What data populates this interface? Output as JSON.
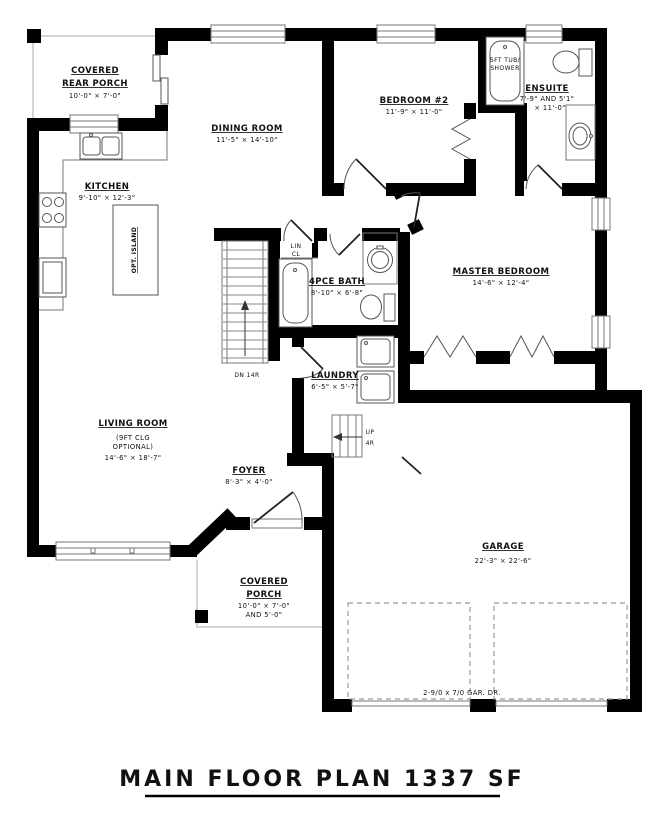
{
  "page": {
    "title": "MAIN FLOOR PLAN 1337 SF"
  },
  "colors": {
    "walls": "#000000",
    "thin_lines": "#777777",
    "text": "#111111",
    "background": "#ffffff"
  },
  "rooms": {
    "rear_porch": {
      "line1": "COVERED",
      "line2": "REAR PORCH",
      "dims": "10'-0\" × 7'-0\""
    },
    "dining": {
      "name": "DINING ROOM",
      "dims": "11'-5\" × 14'-10\""
    },
    "bedroom2": {
      "name": "BEDROOM #2",
      "dims": "11'-9\" × 11'-0\""
    },
    "ensuite": {
      "name": "ENSUITE",
      "dims1": "7'-9\" AND 5'1\"",
      "dims2": "× 11'-0\""
    },
    "kitchen": {
      "name": "KITCHEN",
      "dims": "9'-10\" × 12'-3\""
    },
    "master": {
      "name": "MASTER BEDROOM",
      "dims": "14'-6\" × 12'-4\""
    },
    "bath": {
      "name": "4PCE BATH",
      "dims": "8'-10\" × 6'-8\""
    },
    "linen": {
      "line1": "LIN",
      "line2": "CL"
    },
    "laundry": {
      "name": "LAUNDRY",
      "dims": "6'-5\" × 5'-7\""
    },
    "living": {
      "name": "LIVING ROOM",
      "note1": "(9FT CLG",
      "note2": "OPTIONAL)",
      "dims": "14'-6\" × 18'-7\""
    },
    "foyer": {
      "name": "FOYER",
      "dims": "8'-3\" × 4'-0\""
    },
    "front_porch": {
      "line1": "COVERED",
      "line2": "PORCH",
      "dims1": "10'-0\" × 7'-0\"",
      "dims2": "AND 5'-0\""
    },
    "garage": {
      "name": "GARAGE",
      "dims": "22'-3\" × 22'-6\""
    }
  },
  "annotations": {
    "island": "OPT. ISLAND",
    "tub1": "5FT TUB/",
    "tub2": "SHOWER",
    "stairs_down": "DN 14R",
    "up": "UP",
    "up_risers": "4R",
    "garage_door": "2-9/0 x 7/0 GAR. DR."
  }
}
